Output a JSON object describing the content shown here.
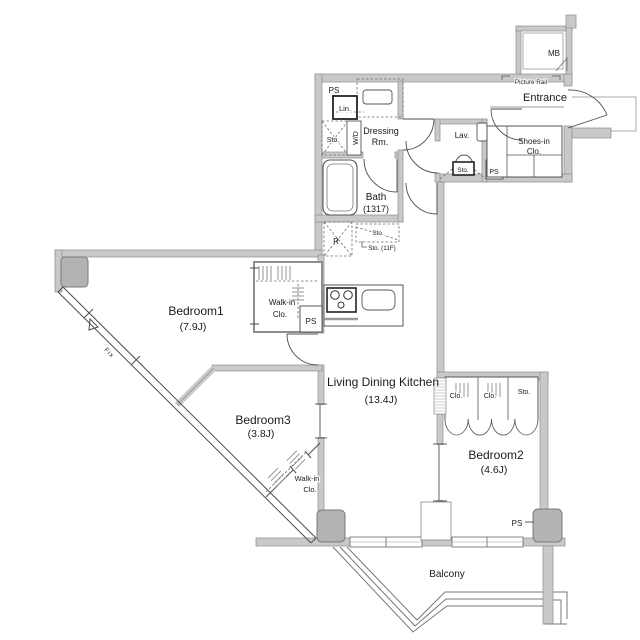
{
  "plan_type": "apartment-floor-plan",
  "colors": {
    "background": "#ffffff",
    "wall_fill": "#c9c9c9",
    "wall_edge": "#8e8e8e",
    "line": "#4d4d4d",
    "text": "#1a1a1a",
    "column_fill": "#b3b3b3"
  },
  "rooms": {
    "bedroom1": {
      "name": "Bedroom1",
      "size": "(7.9J)"
    },
    "bedroom2": {
      "name": "Bedroom2",
      "size": "(4.6J)"
    },
    "bedroom3": {
      "name": "Bedroom3",
      "size": "(3.8J)"
    },
    "ldk": {
      "name": "Living Dining Kitchen",
      "size": "(13.4J)"
    },
    "bath": {
      "name": "Bath",
      "size": "(1317)"
    },
    "dressing": {
      "line1": "Dressing",
      "line2": "Rm."
    },
    "lavatory": {
      "name": "Lav."
    },
    "entrance": {
      "name": "Entrance"
    },
    "balcony": {
      "name": "Balcony"
    },
    "shoes_closet": {
      "line1": "Shoes-in",
      "line2": "Clo."
    },
    "walkin_closet": {
      "line1": "Walk-in",
      "line2": "Clo."
    }
  },
  "fixtures": {
    "mb": "MB",
    "ps": "PS",
    "lin": "Lin.",
    "sto": "Sto.",
    "sto_11f": "Sto. (11F)",
    "wd": "W/D",
    "fridge": "R",
    "clo": "Clo.",
    "picture_rail": "Picture Rail",
    "fix_window": "Fix"
  }
}
